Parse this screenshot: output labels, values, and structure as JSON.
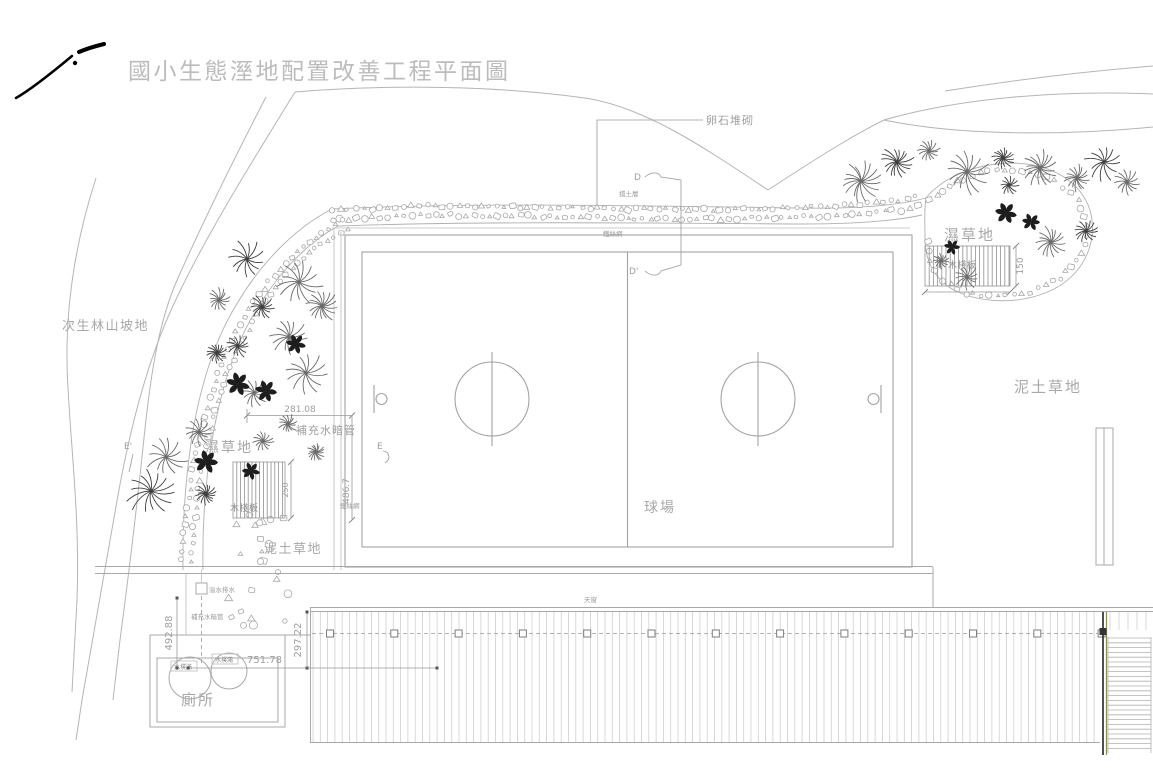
{
  "title": "國小生態溼地配置改善工程平面圖",
  "colors": {
    "ink": "#000000",
    "line_gray": "#b0b0b0",
    "label_gray": "#9e9e9e",
    "plant_dark": "#1d1d1d",
    "olive_accent": "#9a8a30"
  },
  "areas": {
    "secondary_forest": "次生林山坡地",
    "wet_grass_left": "濕草地",
    "wet_grass_right": "濕草地",
    "mud_grass_left": "泥土草地",
    "mud_grass_right": "泥土草地",
    "ball_court": "球場",
    "toilet": "廁所"
  },
  "features": {
    "pebble_stack": "卵石堆砌",
    "soil_layer": "擋土層",
    "wire_mesh_top": "鐵絲網",
    "wire_mesh_left": "鐵絲網",
    "wood_deck_left": "木棧板",
    "wood_deck_right": "木棧板",
    "overflow_drain": "溢水排水",
    "supply_pipe_upper": "補充水暗管",
    "supply_pipe_lower": "補充水暗管",
    "skylight": "天窗",
    "water_tank_left": "水撲滿",
    "water_tank_right": "水撲滿"
  },
  "dimensions": {
    "upper_width": "281.08",
    "left_height": "486.7",
    "deck_left_height": "250",
    "deck_right_height": "150",
    "tank_vertical": "492.88",
    "tank_horizontal": "751.78",
    "canopy_vertical": "297.22"
  },
  "markers": {
    "d": "D",
    "d_prime": "D'",
    "e": "E",
    "e_prime": "E'"
  }
}
